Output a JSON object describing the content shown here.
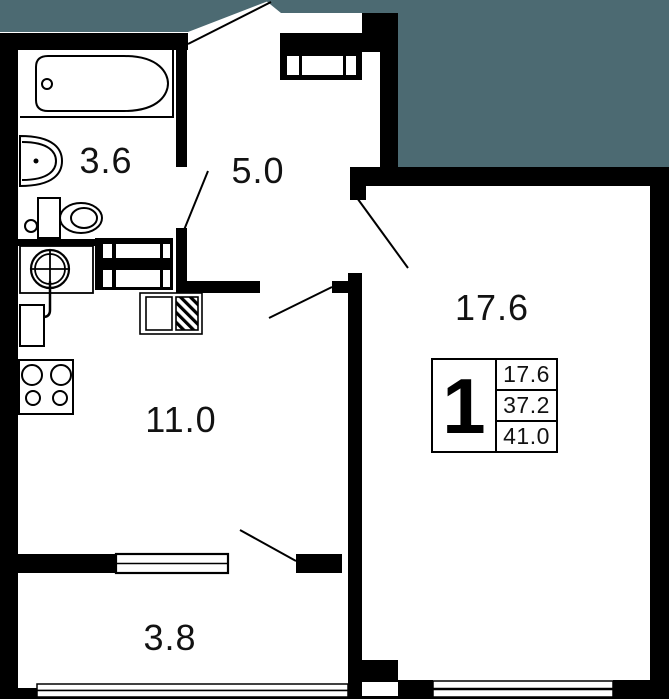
{
  "plan": {
    "rooms": [
      {
        "name": "bathroom",
        "area_label": "3.6"
      },
      {
        "name": "hallway",
        "area_label": "5.0"
      },
      {
        "name": "living-room",
        "area_label": "17.6"
      },
      {
        "name": "kitchen",
        "area_label": "11.0"
      },
      {
        "name": "balcony",
        "area_label": "3.8"
      }
    ],
    "legend": {
      "rooms_count": "1",
      "living_area": "17.6",
      "apartment_area": "37.2",
      "total_area": "41.0"
    },
    "colors": {
      "outside_area": "#4C6A72",
      "walls": "#000000",
      "background": "#FFFFFF"
    }
  }
}
